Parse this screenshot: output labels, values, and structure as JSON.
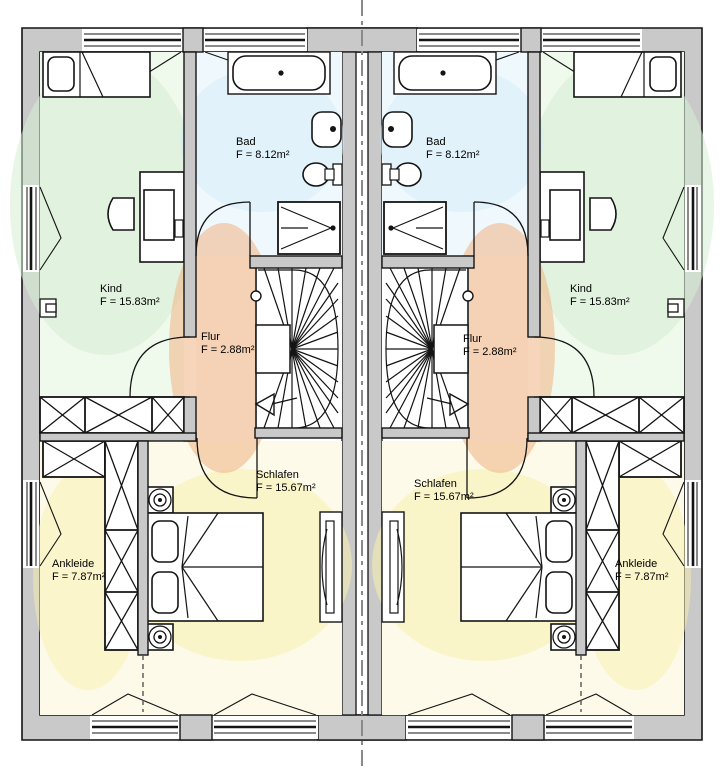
{
  "title": "Obergeschoss Grundriss Doppelhaus",
  "units": {
    "left": {
      "kind": {
        "name": "Kind",
        "area": "F = 15.83m²"
      },
      "bad": {
        "name": "Bad",
        "area": "F = 8.12m²"
      },
      "flur": {
        "name": "Flur",
        "area": "F = 2.88m²"
      },
      "schlafen": {
        "name": "Schlafen",
        "area": "F = 15.67m²"
      },
      "ankleide": {
        "name": "Ankleide",
        "area": "F = 7.87m²"
      }
    },
    "right": {
      "kind": {
        "name": "Kind",
        "area": "F = 15.83m²"
      },
      "bad": {
        "name": "Bad",
        "area": "F = 8.12m²"
      },
      "flur": {
        "name": "Flur",
        "area": "F = 2.88m²"
      },
      "schlafen": {
        "name": "Schlafen",
        "area": "F = 15.67m²"
      },
      "ankleide": {
        "name": "Ankleide",
        "area": "F = 7.87m²"
      }
    }
  },
  "colors": {
    "wall": "#c9c9c9",
    "outline": "#141414",
    "kind_tint": "#d5eed3",
    "bad_tint": "#d3ecf8",
    "flur_tint": "#f0b98c",
    "sleep_tint": "#f8f0ae",
    "centerline": "#8a8a8a"
  }
}
